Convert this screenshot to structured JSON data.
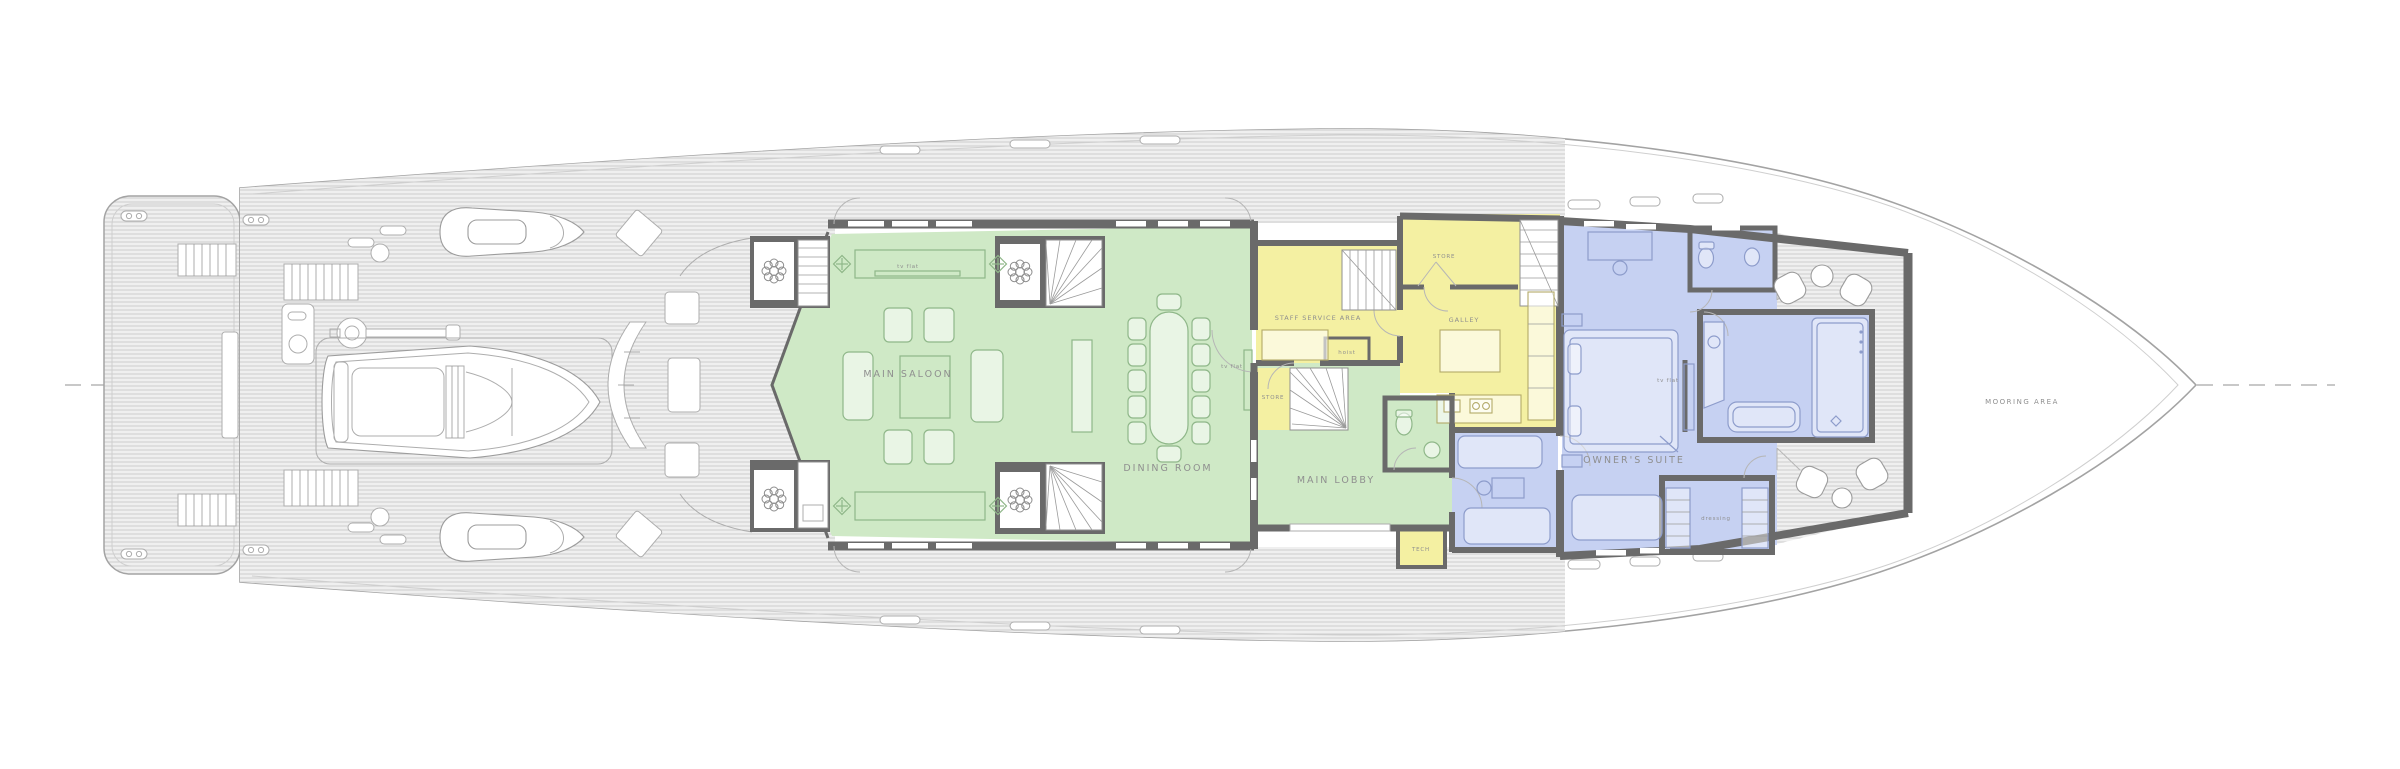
{
  "plan_title": "Yacht main deck general arrangement plan",
  "colors": {
    "green": "#cfe9c6",
    "yellow": "#f4f0a2",
    "blue": "#c6d1f2",
    "wall": "#6a6a6a",
    "outline": "#a3a3a3",
    "label": "#8f8f8f"
  },
  "labels": {
    "main_saloon": "MAIN SALOON",
    "dining_room": "DINING ROOM",
    "main_lobby": "MAIN LOBBY",
    "staff_service_area": "STAFF SERVICE AREA",
    "galley": "GALLEY",
    "store_fwd": "STORE",
    "store_aft": "STORE",
    "hoist": "hoist",
    "tech": "TECH",
    "owners_suite": "OWNER'S SUITE",
    "dressing": "dressing",
    "tv_flat_saloon": "tv flat",
    "tv_flat_dining": "tv flat",
    "tv_flat_suite": "tv flat",
    "mooring_area": "MOORING AREA"
  }
}
